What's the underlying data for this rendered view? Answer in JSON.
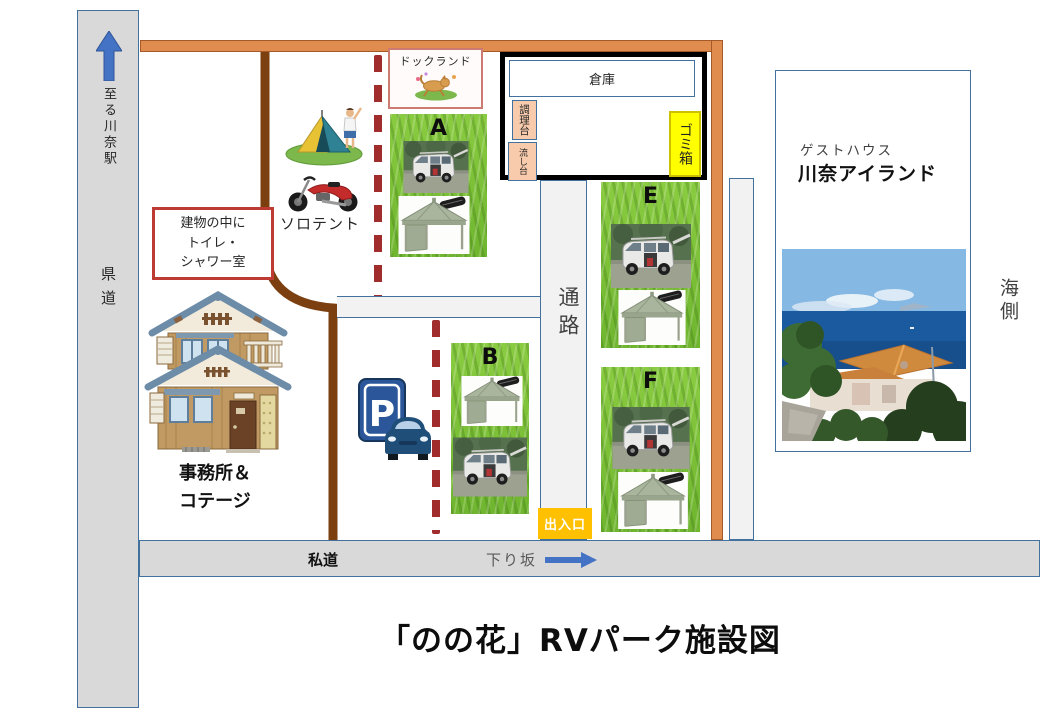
{
  "title": "「のの花」RVパーク施設図",
  "left_road": {
    "to_station": "至る川奈駅",
    "label": "県道"
  },
  "bottom_road": {
    "private_label": "私道",
    "downhill_label": "下り坂"
  },
  "passage": {
    "label": "通路",
    "entrance_label": "出入口"
  },
  "sea_side_label": "海側",
  "dog_land": {
    "label": "ドックランド"
  },
  "facility": {
    "warehouse": "倉庫",
    "cooking_counter": "調理台",
    "sink": "流し台",
    "trash_box": "ゴミ箱"
  },
  "toilet_note": {
    "line1": "建物の中に",
    "line2": "トイレ・",
    "line3": "シャワー室"
  },
  "solo_tent_label": "ソロテント",
  "office": {
    "line1": "事務所＆",
    "line2": "コテージ"
  },
  "parking": {
    "sign_letter": "P"
  },
  "guesthouse": {
    "type": "ゲストハウス",
    "name": "川奈アイランド"
  },
  "sites": [
    {
      "id": "A"
    },
    {
      "id": "B"
    },
    {
      "id": "E"
    },
    {
      "id": "F"
    }
  ],
  "colors": {
    "road_gray": "#D9D9D9",
    "road_border": "#41719C",
    "orange_bar": "#E08C4F",
    "brown_road": "#7B3F10",
    "red_dashed": "#A02C2C",
    "trash_yellow": "#FFFF00",
    "entrance_amber": "#FFC000",
    "counter_peach": "#F8CBAD",
    "grass_green": "#7DC242",
    "arrow_blue": "#4472C4",
    "note_border_red": "#BE3B34",
    "dogland_border": "#CC7B72"
  }
}
